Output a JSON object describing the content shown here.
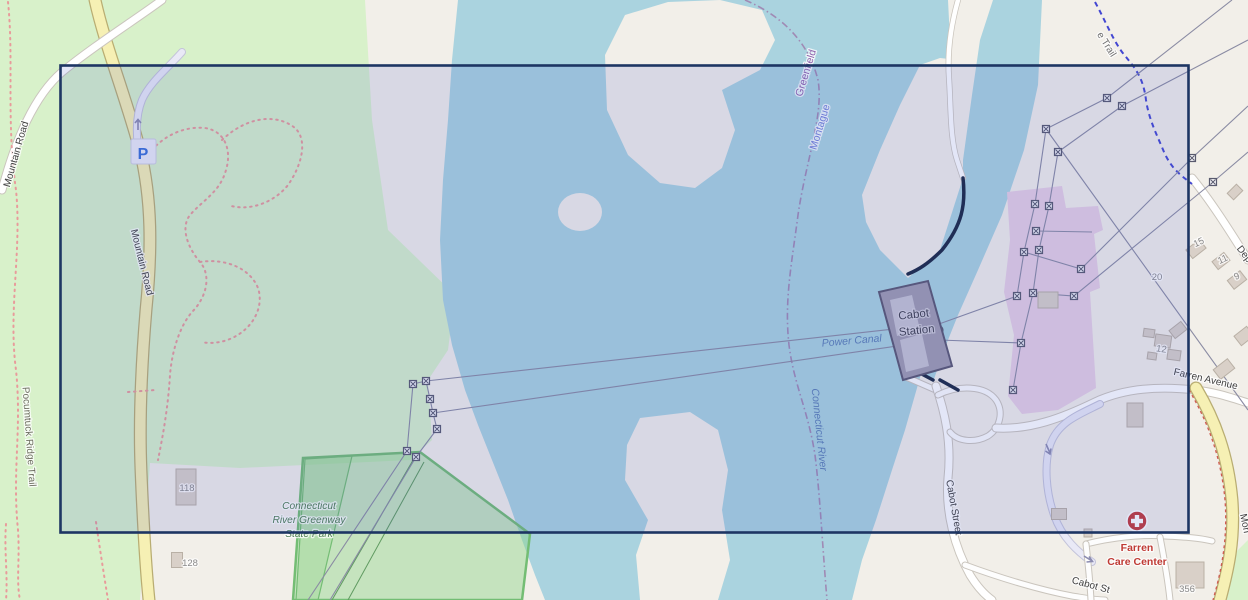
{
  "map": {
    "description": "openstreetmap-style map tile with rectangular selection overlay",
    "labels": {
      "mountain_road_west": "Mountain Road",
      "mountain_road_main": "Mountain Road",
      "pocumtuck_ridge_trail": "Pocumtuck Ridge Trail",
      "state_park_line1": "Connecticut",
      "state_park_line2": "River Greenway",
      "state_park_line3": "State Park",
      "greenfield": "Greenfield",
      "montague": "Montague",
      "power_canal": "Power Canal",
      "connecticut_river": "Connecticut River",
      "cabot_station_line1": "Cabot",
      "cabot_station_line2": "Station",
      "cabot_street": "Cabot Street",
      "cabot_street_south": "Cabot St",
      "farren_avenue": "Farren Avenue",
      "farren_care_line1": "Farren",
      "farren_care_line2": "Care Center",
      "trail_partial": "e Trail",
      "depot_road_partial": "Dep",
      "montague_city_partial": "Mon",
      "parking": "P"
    },
    "house_numbers": {
      "n118": "118",
      "n128": "128",
      "n15": "15",
      "n11": "11",
      "n9": "9",
      "n20": "20",
      "n12": "12",
      "n356": "356"
    }
  },
  "colors": {
    "land": "#f2efe9",
    "green": "#d8f1ca",
    "water": "#aad3df",
    "park_bright": "#8fd489",
    "park_stroke": "#74bd74",
    "purple_industrial": "#e7cfe3",
    "road_yellow": "#f6f0b4",
    "road_casing_yellow": "#b9ad72",
    "road_casing": "#cac5bd",
    "building": "#d9d0c8",
    "building_stroke": "#b9b0a5",
    "red_trail": "#e89b9b",
    "blue_trail": "#4347d2",
    "boundary": "#a08ab4",
    "powerline": "#8a8ba3",
    "water_label": "#5b7fb5",
    "green_label": "#4e7d52",
    "place_purple": "#8e62ad",
    "place_blue": "#7381d8",
    "road_label": "#414141",
    "housenum": "#8a8a8a",
    "care_red": "#bf3a34",
    "dam": "#1b2742",
    "station_fill": "#a09cb0",
    "station_stroke": "#5b5870",
    "station_inner": "#c6c3d2",
    "selection_fill": "rgba(64,86,200,0.15)",
    "selection_border": "#1d3563",
    "parking_blue": "#3a6fd8"
  }
}
